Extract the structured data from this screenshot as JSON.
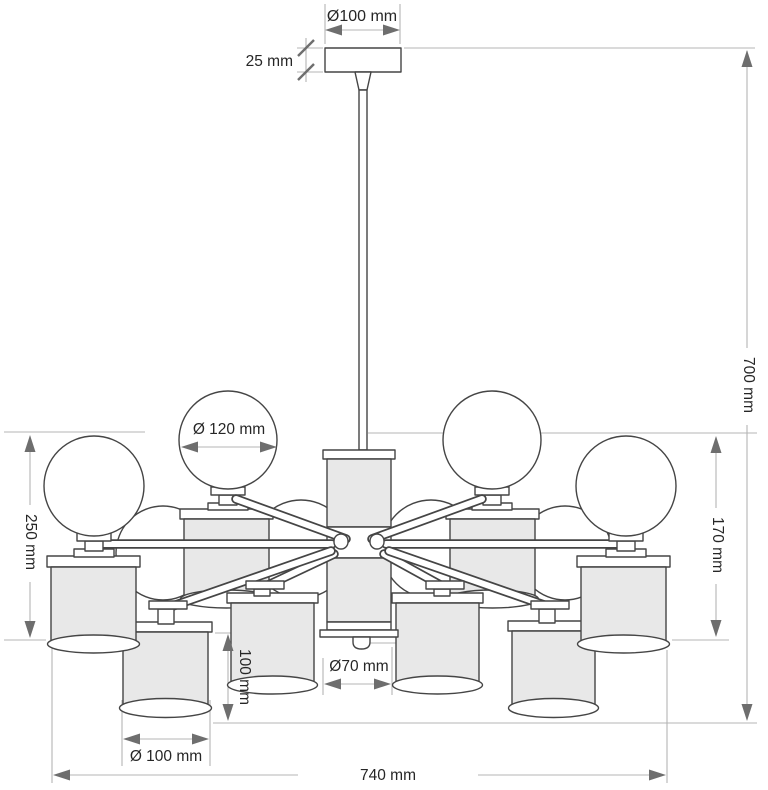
{
  "drawing": {
    "title": "Chandelier technical dimension drawing",
    "dims": {
      "canopy_diameter": "Ø100 mm",
      "canopy_height": "25 mm",
      "globe_diameter": "Ø 120 mm",
      "overall_height": "700 mm",
      "body_height": "170 mm",
      "left_height": "250 mm",
      "shade_height": "100 mm",
      "column_diameter": "Ø70 mm",
      "shade_diameter": "Ø 100 mm",
      "overall_width": "740 mm"
    },
    "colors": {
      "line": "#454545",
      "shade_fill": "#e8e8e8",
      "dimension_line": "#b4b4b4",
      "arrow": "#6e6e6e",
      "text": "#262626",
      "background": "#ffffff"
    }
  }
}
